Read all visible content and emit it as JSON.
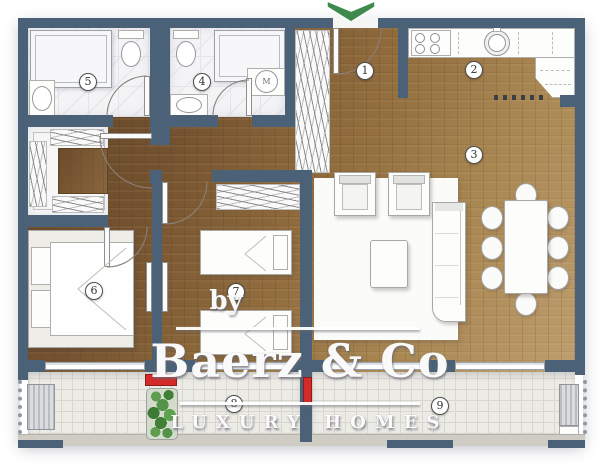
{
  "plan_labels": {
    "room_numbers": [
      "1",
      "2",
      "3",
      "4",
      "5",
      "6",
      "7",
      "8",
      "9"
    ],
    "washing_machine": "M"
  },
  "watermark": {
    "by": "by",
    "brand": "Baerz & Co",
    "tagline": "LUXURY HOMES"
  },
  "icons": {
    "entry_arrow": "chevron-down"
  },
  "colors": {
    "wall": "#4a6178",
    "wood_dark": "#5e4325",
    "wood_light": "#bf9e6f",
    "balcony_tile": "#ecebe5",
    "marble": "#f4f4f6",
    "accent_red": "#d42a28",
    "plant_green": "#4e8c43",
    "arrow_green": "#3e8a4c",
    "label_ink": "#333333"
  }
}
